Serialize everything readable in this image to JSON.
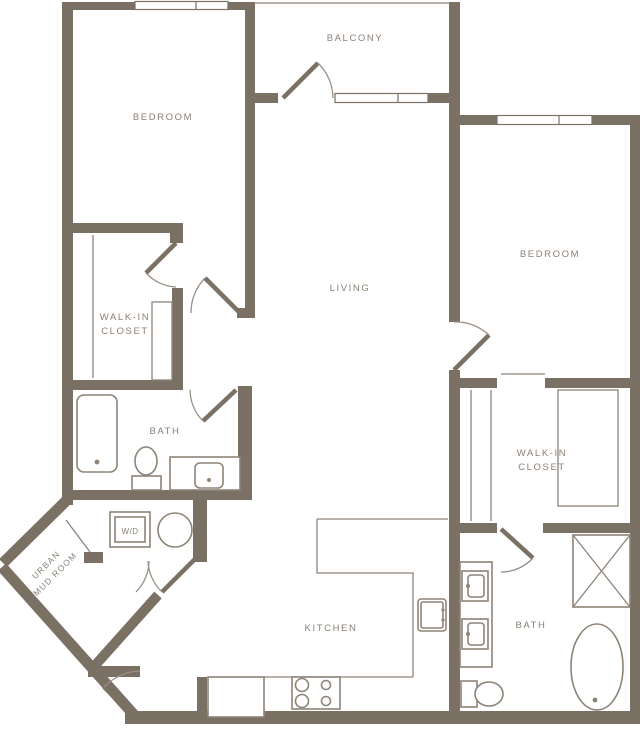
{
  "title": "Two bedroom two bath apartment floor plan",
  "colors": {
    "wall": "#7b7064",
    "fixture_line": "#8d8377",
    "label_text": "#8b8178",
    "background": "#ffffff"
  },
  "rooms": {
    "bedroom_left": {
      "label": "BEDROOM"
    },
    "balcony": {
      "label": "BALCONY"
    },
    "bedroom_right": {
      "label": "BEDROOM"
    },
    "living": {
      "label": "LIVING"
    },
    "closet_left": {
      "line1": "WALK-IN",
      "line2": "CLOSET"
    },
    "bath_left": {
      "label": "BATH"
    },
    "laundry": {
      "label": "W/D"
    },
    "mud_room": {
      "line1": "URBAN",
      "line2": "MUD ROOM"
    },
    "kitchen": {
      "label": "KITCHEN"
    },
    "closet_right": {
      "line1": "WALK-IN",
      "line2": "CLOSET"
    },
    "bath_right": {
      "label": "BATH"
    }
  },
  "fixtures": [
    {
      "name": "bathtub-icon",
      "room": "bath-left"
    },
    {
      "name": "toilet-icon",
      "room": "bath-left"
    },
    {
      "name": "sink-vanity-icon",
      "room": "bath-left"
    },
    {
      "name": "washer-dryer-icon",
      "room": "laundry"
    },
    {
      "name": "water-heater-icon",
      "room": "laundry"
    },
    {
      "name": "kitchen-sink-icon",
      "room": "kitchen"
    },
    {
      "name": "cooktop-icon",
      "room": "kitchen"
    },
    {
      "name": "cabinet-icon",
      "room": "kitchen"
    },
    {
      "name": "double-sink-vanity-icon",
      "room": "bath-right"
    },
    {
      "name": "toilet-icon",
      "room": "bath-right"
    },
    {
      "name": "freestanding-tub-icon",
      "room": "bath-right"
    },
    {
      "name": "shower-icon",
      "room": "bath-right"
    }
  ]
}
